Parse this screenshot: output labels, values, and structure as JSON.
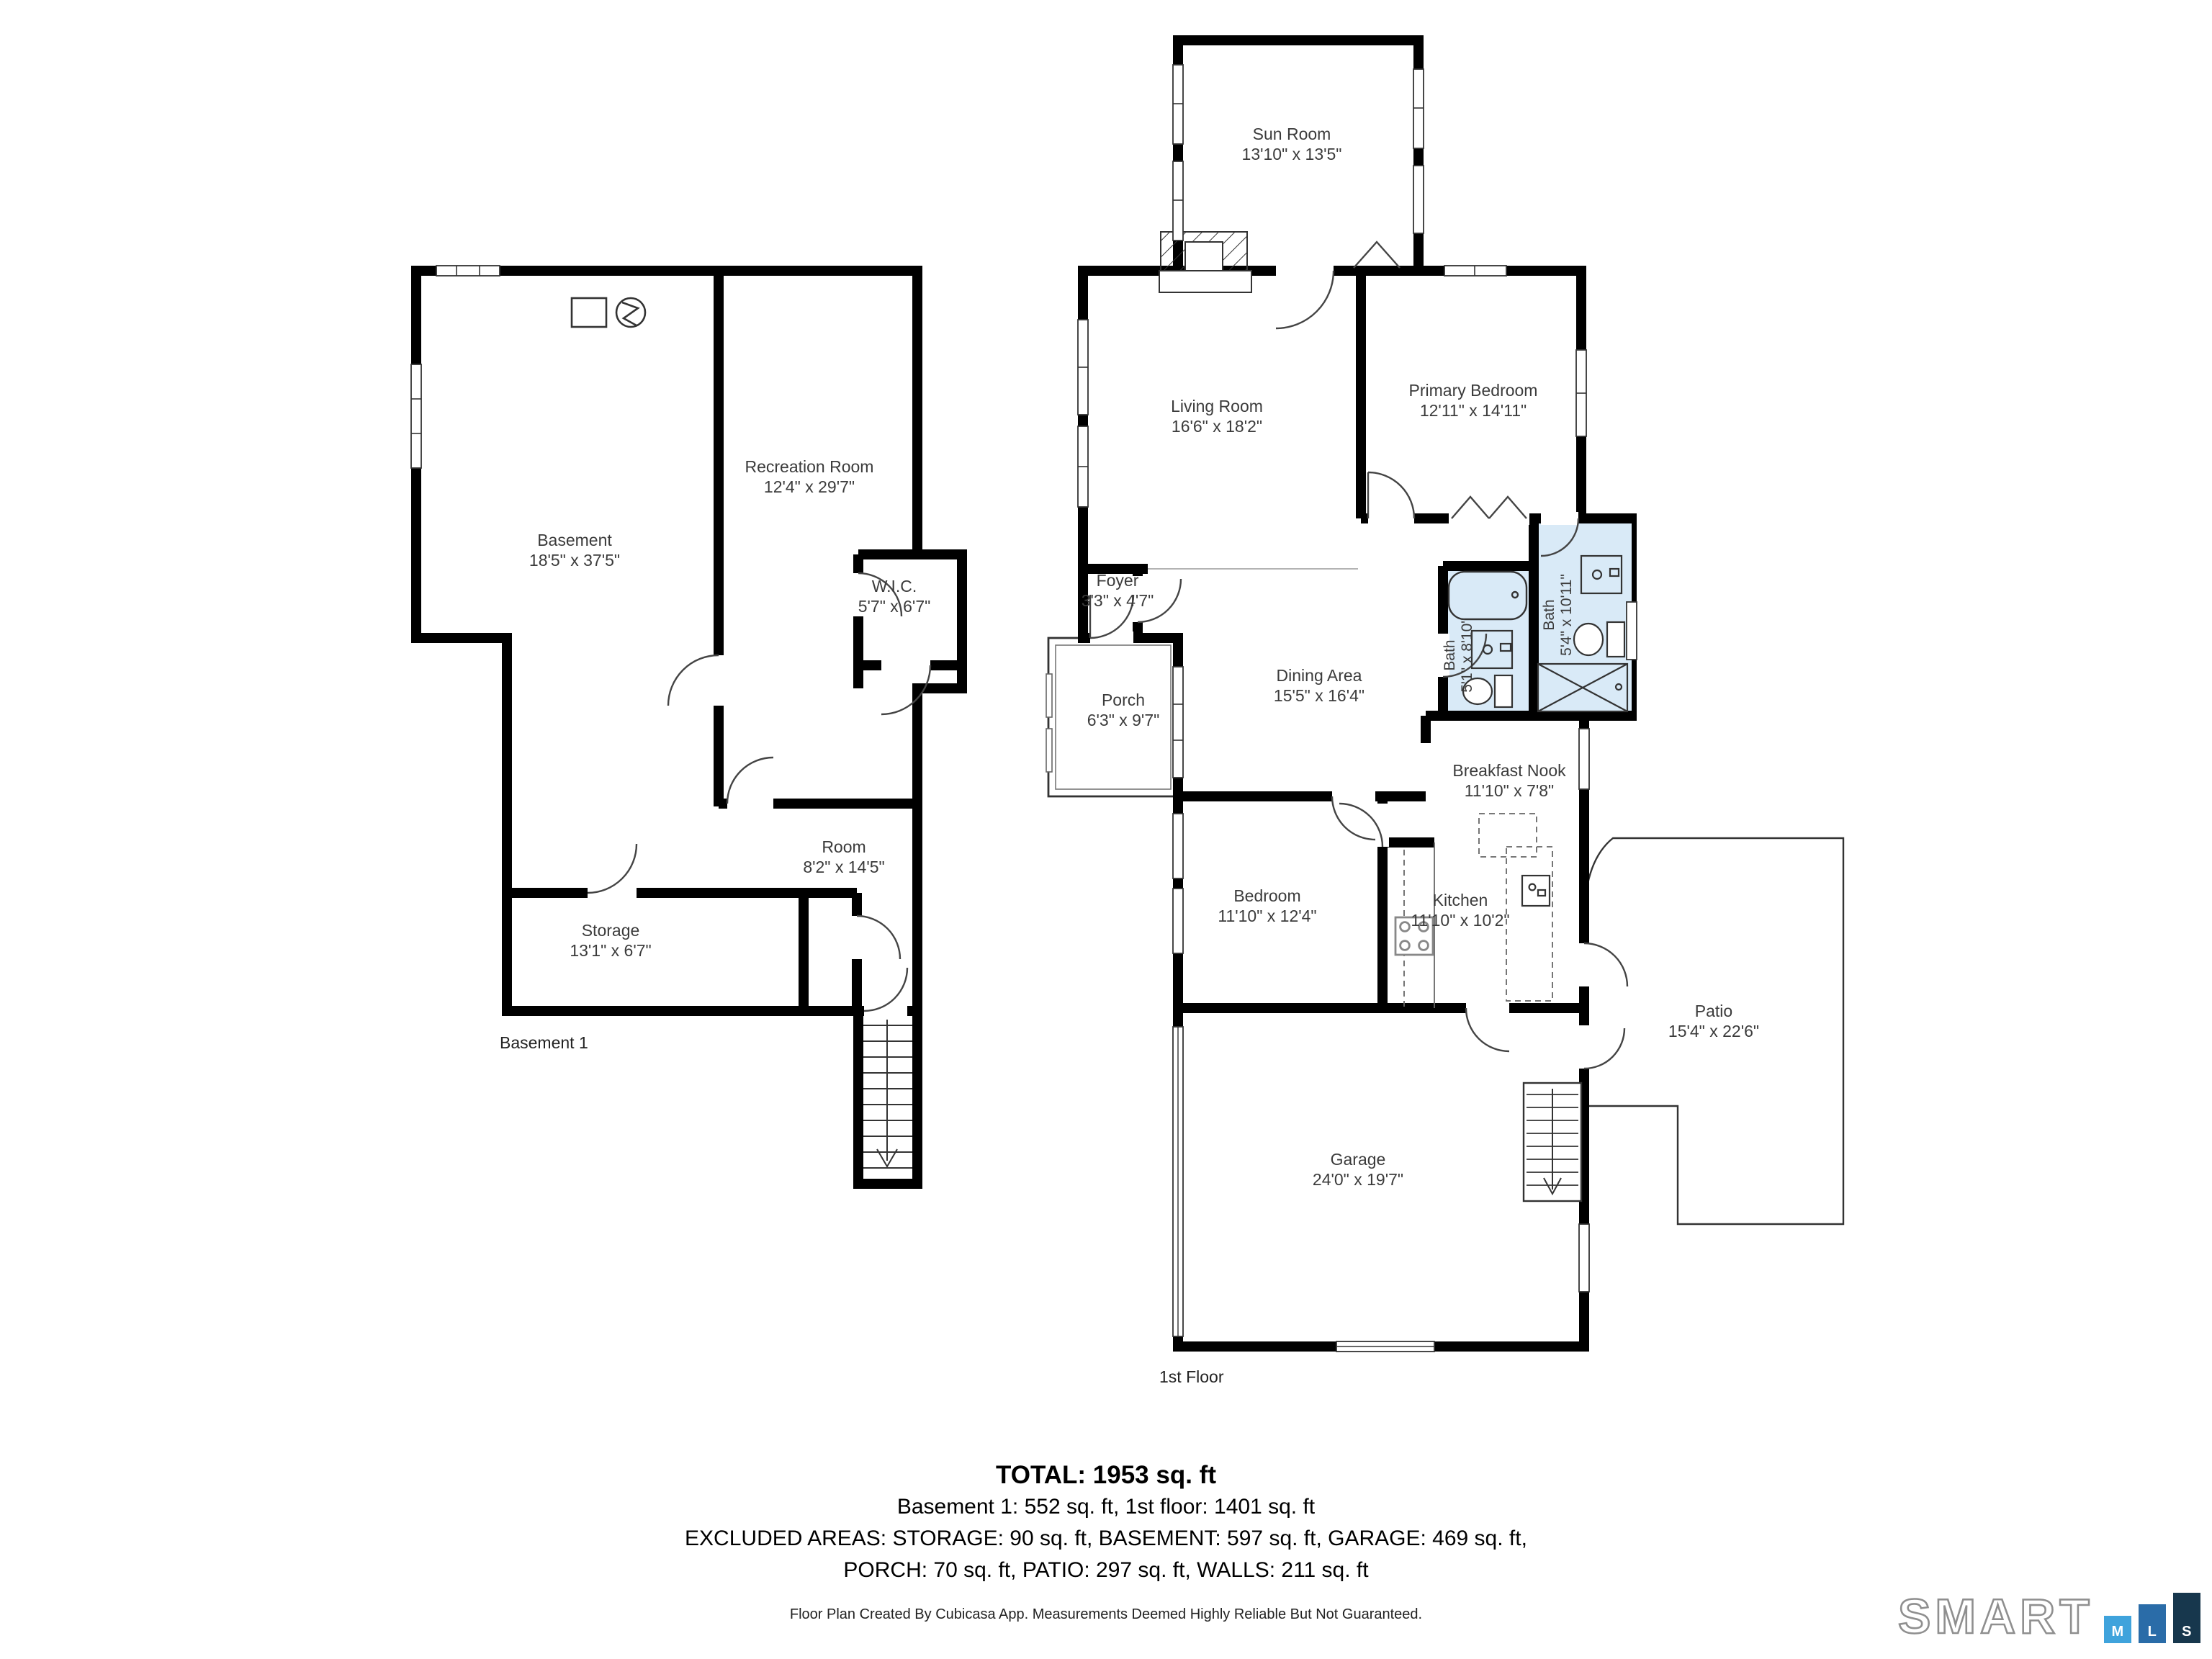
{
  "floors": [
    {
      "label": "Basement 1",
      "rooms": [
        {
          "name": "Basement",
          "dims": "18'5\" x 37'5\""
        },
        {
          "name": "Recreation Room",
          "dims": "12'4\" x 29'7\""
        },
        {
          "name": "W.I.C.",
          "dims": "5'7\" x 6'7\""
        },
        {
          "name": "Room",
          "dims": "8'2\" x 14'5\""
        },
        {
          "name": "Storage",
          "dims": "13'1\" x 6'7\""
        }
      ]
    },
    {
      "label": "1st Floor",
      "rooms": [
        {
          "name": "Sun Room",
          "dims": "13'10\" x 13'5\""
        },
        {
          "name": "Living Room",
          "dims": "16'6\" x 18'2\""
        },
        {
          "name": "Primary Bedroom",
          "dims": "12'11\" x 14'11\""
        },
        {
          "name": "Foyer",
          "dims": "3'3\" x 4'7\""
        },
        {
          "name": "Porch",
          "dims": "6'3\" x 9'7\""
        },
        {
          "name": "Dining Area",
          "dims": "15'5\" x 16'4\""
        },
        {
          "name": "Bath",
          "dims": "5'1\" x 8'10\""
        },
        {
          "name": "Bath",
          "dims": "5'4\" x 10'11\""
        },
        {
          "name": "Breakfast Nook",
          "dims": "11'10\" x 7'8\""
        },
        {
          "name": "Bedroom",
          "dims": "11'10\" x 12'4\""
        },
        {
          "name": "Kitchen",
          "dims": "11'10\" x 10'2\""
        },
        {
          "name": "Garage",
          "dims": "24'0\" x 19'7\""
        },
        {
          "name": "Patio",
          "dims": "15'4\" x 22'6\""
        }
      ]
    }
  ],
  "summary": {
    "total": "TOTAL: 1953 sq. ft",
    "floors_line": "Basement 1: 552 sq. ft, 1st floor: 1401 sq. ft",
    "excluded_line1": "EXCLUDED AREAS: STORAGE: 90 sq. ft, BASEMENT: 597 sq. ft, GARAGE: 469 sq. ft,",
    "excluded_line2": "PORCH: 70 sq. ft, PATIO: 297 sq. ft, WALLS: 211 sq. ft"
  },
  "footer": {
    "disclaimer": "Floor Plan Created By Cubicasa App. Measurements Deemed Highly Reliable But Not Guaranteed."
  },
  "brand": {
    "word": "SMART",
    "bars": [
      "M",
      "L",
      "S"
    ],
    "colors": {
      "m": "#3fa3dc",
      "l": "#2a6ca8",
      "s": "#17374d"
    }
  },
  "colors": {
    "wall": "#000000",
    "bath_fill": "#d9eaf7",
    "text": "#3b3b3b"
  }
}
